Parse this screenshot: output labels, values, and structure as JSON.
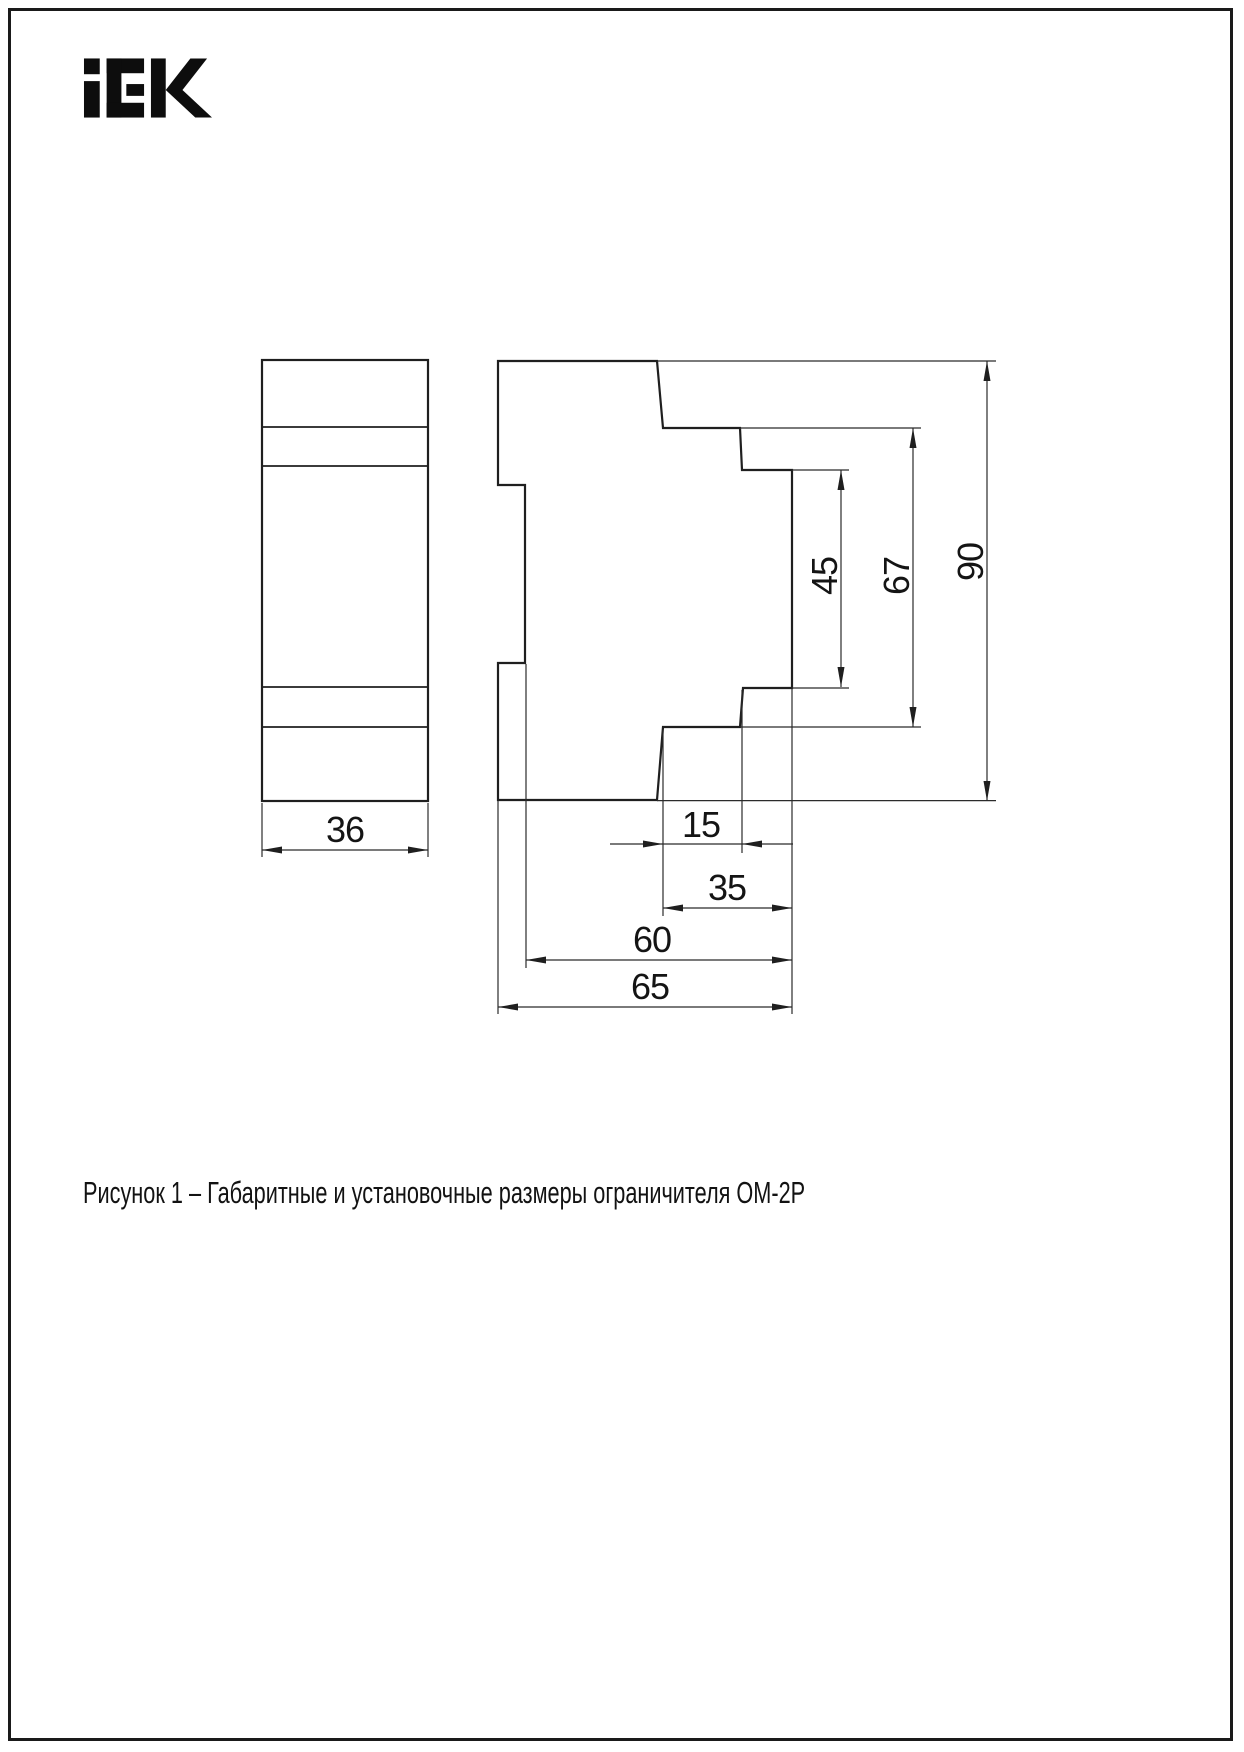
{
  "logo": {
    "brand": "iEK"
  },
  "figure": {
    "caption": "Рисунок 1 – Габаритные и установочные размеры ограничителя ОМ-2Р"
  },
  "dimensions": {
    "front_width": "36",
    "rail_offset": "15",
    "step_width": "35",
    "body_depth": "60",
    "total_depth": "65",
    "rail_height": "45",
    "step_height": "67",
    "total_height": "90"
  },
  "colors": {
    "line": "#1f1f1f",
    "text": "#141414"
  }
}
